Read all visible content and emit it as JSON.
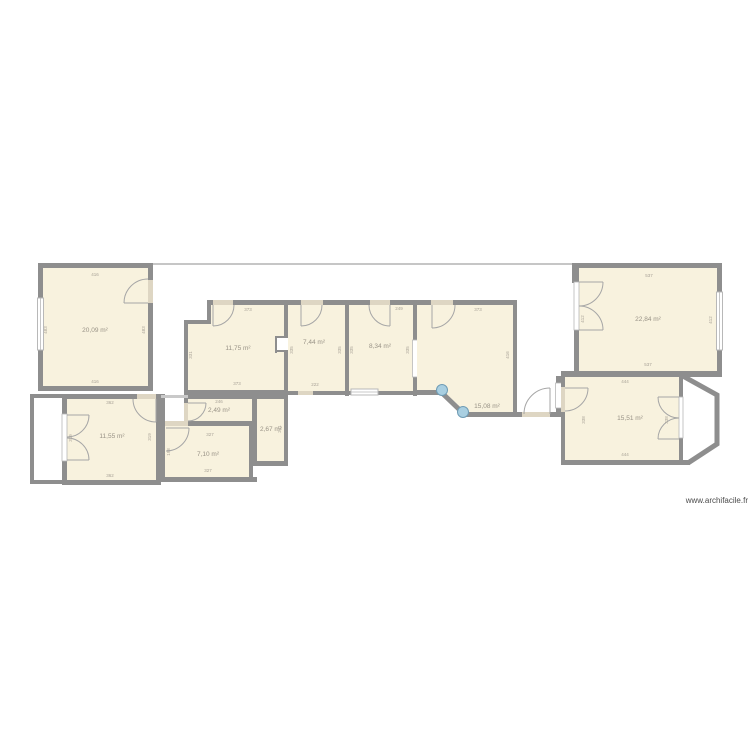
{
  "watermark": "www.archifacile.fr",
  "colors": {
    "room_fill": "#f8f2de",
    "wall": "#8e8e8e",
    "thin_line": "#b3b3b3",
    "door_opening": "#ded6c3",
    "door_arc": "#a6a6a6",
    "glass_window_fill": "#ffffff",
    "glass_door_accent": "#a9cfe1",
    "label_text": "#989286",
    "watermark_text": "#4a4a4a"
  },
  "rooms": {
    "a": {
      "area": "20,09 m²",
      "w": "416",
      "h": "483"
    },
    "b": {
      "area": "11,55 m²",
      "w": "362",
      "h": "319"
    },
    "c": {
      "area": "2,49 m²",
      "w": "246",
      "h": "86"
    },
    "d": {
      "area": "2,67 m²",
      "w": "105",
      "h": "241"
    },
    "e": {
      "area": "7,10 m²",
      "w": "327",
      "h": "198"
    },
    "f": {
      "area": "11,75 m²",
      "w": "373",
      "h": "331"
    },
    "g": {
      "area": "7,44 m²",
      "w": "222",
      "h": "335"
    },
    "h": {
      "area": "8,34 m²",
      "w": "249",
      "h": "335"
    },
    "i": {
      "area": "15,08 m²",
      "w": "373",
      "h": "416"
    },
    "k": {
      "area": "15,51 m²",
      "w": "444",
      "h": "338"
    },
    "l": {
      "area": "22,84 m²",
      "w": "537",
      "h": "412"
    }
  }
}
